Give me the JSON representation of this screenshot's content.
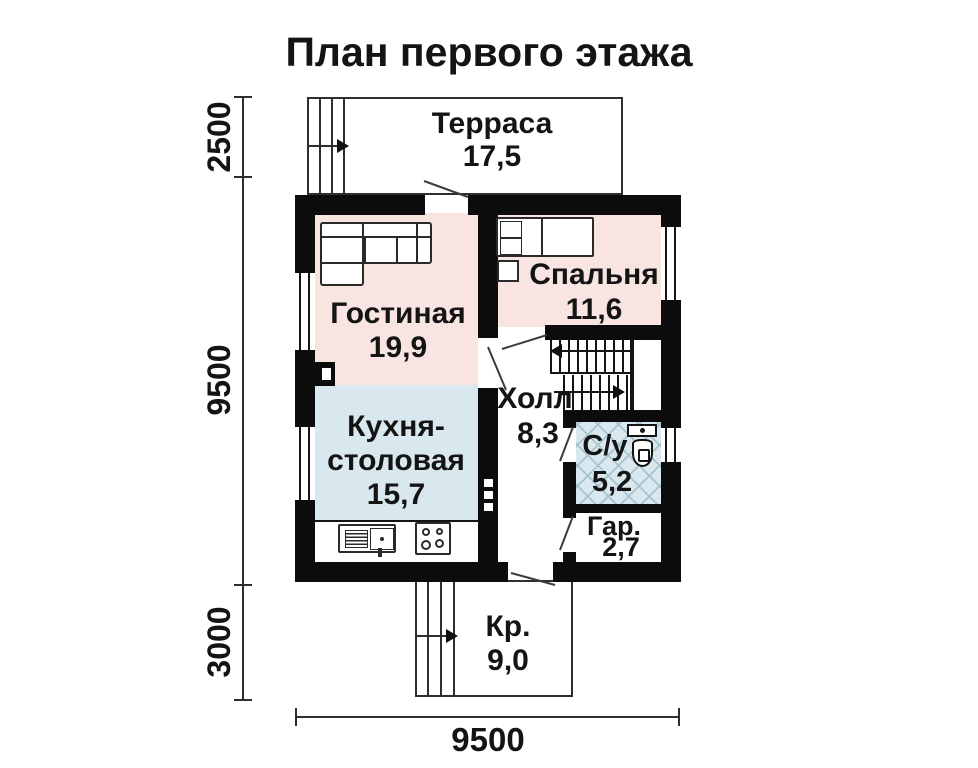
{
  "title": "План первого этажа",
  "rooms": {
    "terrace": {
      "name": "Терраса",
      "area": "17,5"
    },
    "living": {
      "name": "Гостиная",
      "area": "19,9"
    },
    "bedroom": {
      "name": "Спальня",
      "area": "11,6"
    },
    "kitchen": {
      "name_line1": "Кухня-",
      "name_line2": "столовая",
      "area": "15,7"
    },
    "hall": {
      "name": "Холл",
      "area": "8,3"
    },
    "bathroom": {
      "name": "С/у",
      "area": "5,2"
    },
    "wardrobe": {
      "name": "Гар.",
      "area": "2,7"
    },
    "porch": {
      "name": "Кр.",
      "area": "9,0"
    }
  },
  "dimensions": {
    "terrace_depth": "2500",
    "house_depth": "9500",
    "porch_depth": "3000",
    "house_width": "9500"
  },
  "colors": {
    "wall": "#0c0c0c",
    "room_pink": "#f8e5e1",
    "room_blue": "#d8e8ee",
    "lattice_line": "#a9c3cd",
    "text": "#141414"
  }
}
